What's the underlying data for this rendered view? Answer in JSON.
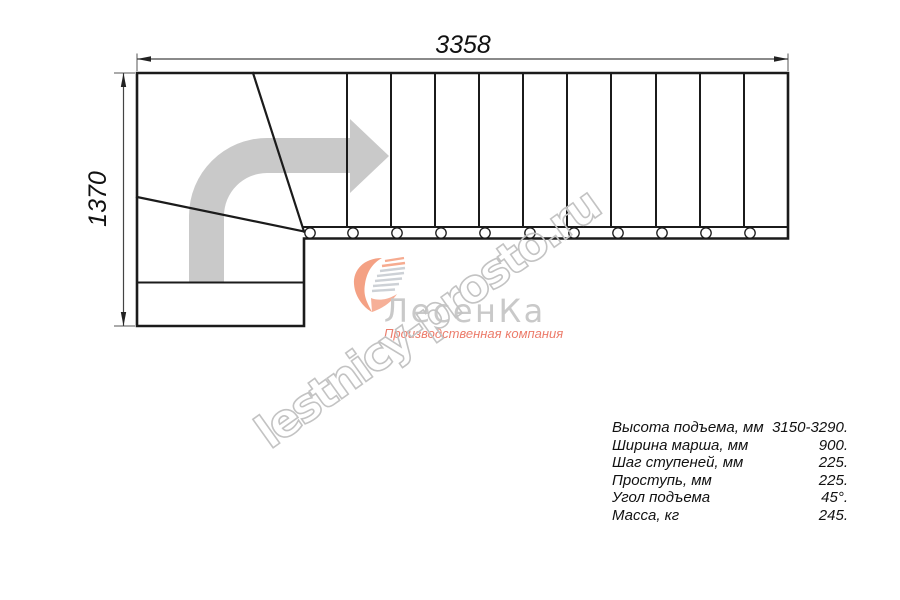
{
  "drawing": {
    "title": "L-shaped staircase plan",
    "width_dimension_label": "3358",
    "height_dimension_label": "1370"
  },
  "watermark": {
    "text": "lestnicy-prosto.ru"
  },
  "logo": {
    "name": "ЛесенКа",
    "tagline": "Производственная компания"
  },
  "specs": {
    "rows": [
      {
        "label": "Высота подъема, мм",
        "value": "3150-3290."
      },
      {
        "label": "Ширина марша, мм",
        "value": "900."
      },
      {
        "label": "Шаг ступеней, мм",
        "value": "225."
      },
      {
        "label": "Проступь, мм",
        "value": "225."
      },
      {
        "label": "Угол подъема",
        "value": "45°."
      },
      {
        "label": "Масса, кг",
        "value": "245."
      }
    ]
  },
  "colors": {
    "line_black": "#1b1b1b",
    "dimension_gray": "#444444",
    "arrow_gray": "#c9c9c9",
    "watermark_gray": "#c3c3c3",
    "logo_name_gray": "#c9c9c9",
    "logo_tagline_salmon": "#ec7c6b",
    "logo_heart_peach": "#f4a184"
  }
}
